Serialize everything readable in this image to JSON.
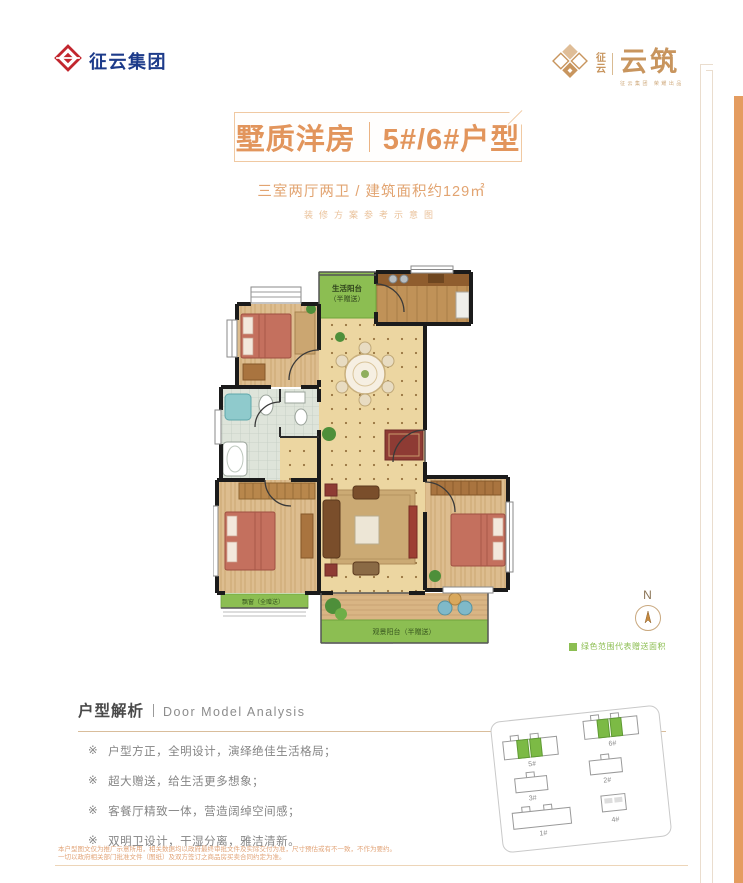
{
  "brand": {
    "left_logo_text": "征云集团",
    "right_logo_small": "征云",
    "right_logo_main": "云筑",
    "right_logo_tagline": "征云集团 荣耀出品"
  },
  "title": {
    "left": "墅质洋房",
    "right": "5#/6#户型",
    "subtitle": "三室两厅两卫 / 建筑面积约129㎡",
    "note": "装修方案参考示意图"
  },
  "floorplan": {
    "life_balcony_line1": "生活阳台",
    "life_balcony_line2": "（半赠送）",
    "bay_window_label": "飘窗（全赠送）",
    "view_balcony_label": "观景阳台（半赠送）",
    "compass_label": "N",
    "legend_text": "绿色范围代表赠送面积",
    "gift_color": "#8CBE52"
  },
  "analysis": {
    "heading": "户型解析",
    "heading_en": "Door Model Analysis",
    "bullets": [
      {
        "marker": "※",
        "text": "户型方正，全明设计，演绎绝佳生活格局；"
      },
      {
        "marker": "※",
        "text": "超大赠送，给生活更多想象；"
      },
      {
        "marker": "※",
        "text": "客餐厅精致一体，营造阔绰空间感；"
      },
      {
        "marker": "※",
        "text": "双明卫设计，干湿分离，雅洁清新。"
      }
    ]
  },
  "siteplan": {
    "buildings": [
      {
        "label": "5#",
        "highlight": true
      },
      {
        "label": "6#",
        "highlight": true
      },
      {
        "label": "3#",
        "highlight": false
      },
      {
        "label": "2#",
        "highlight": false
      },
      {
        "label": "1#",
        "highlight": false
      },
      {
        "label": "4#",
        "highlight": false
      }
    ]
  },
  "footer": {
    "line1": "本户型图文仅为推广示意所用，相关数据均以政府最终审批文件及实际交付为准，尺寸预估或有不一致，不作为要约。",
    "line2": "一切以政府相关部门批准文件（图纸）及双方签订之商品房买卖合同约定为准。"
  },
  "colors": {
    "accent": "#E2955C",
    "bar": "#E49C60",
    "navy": "#1D3B8A",
    "gold": "#C8955E"
  }
}
